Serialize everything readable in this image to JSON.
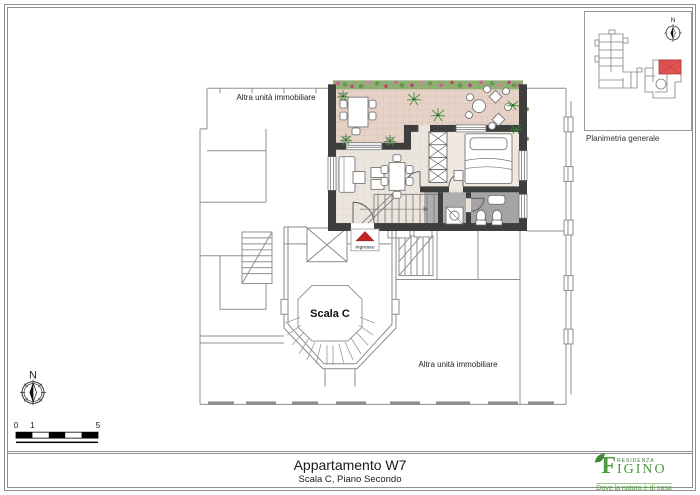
{
  "page": {
    "title": "Appartamento W7",
    "subtitle": "Scala C, Piano Secondo"
  },
  "plan": {
    "label_other_unit_top": "Altra unità immobiliare",
    "label_other_unit_bottom": "Altra unità immobiliare",
    "label_staircase": "Scala C",
    "label_entrance": "Ingresso",
    "entrance_arrow_color": "#c32222",
    "wall_color": "#3e3e3e",
    "terrace_floor_color": "#e6d2c7",
    "bath_floor_color": "#a6a6a6"
  },
  "inset": {
    "caption": "Planimetria generale",
    "compass_n": "N",
    "highlight_color": "#e05353"
  },
  "compass": {
    "label": "N"
  },
  "scalebar": {
    "t0": "0",
    "t1": "1",
    "t5": "5"
  },
  "logo": {
    "f": "F",
    "small": "RESIDENZA",
    "rest": "IGINO",
    "tagline": "Dove la natura è di casa",
    "green": "#4e9a3e"
  }
}
